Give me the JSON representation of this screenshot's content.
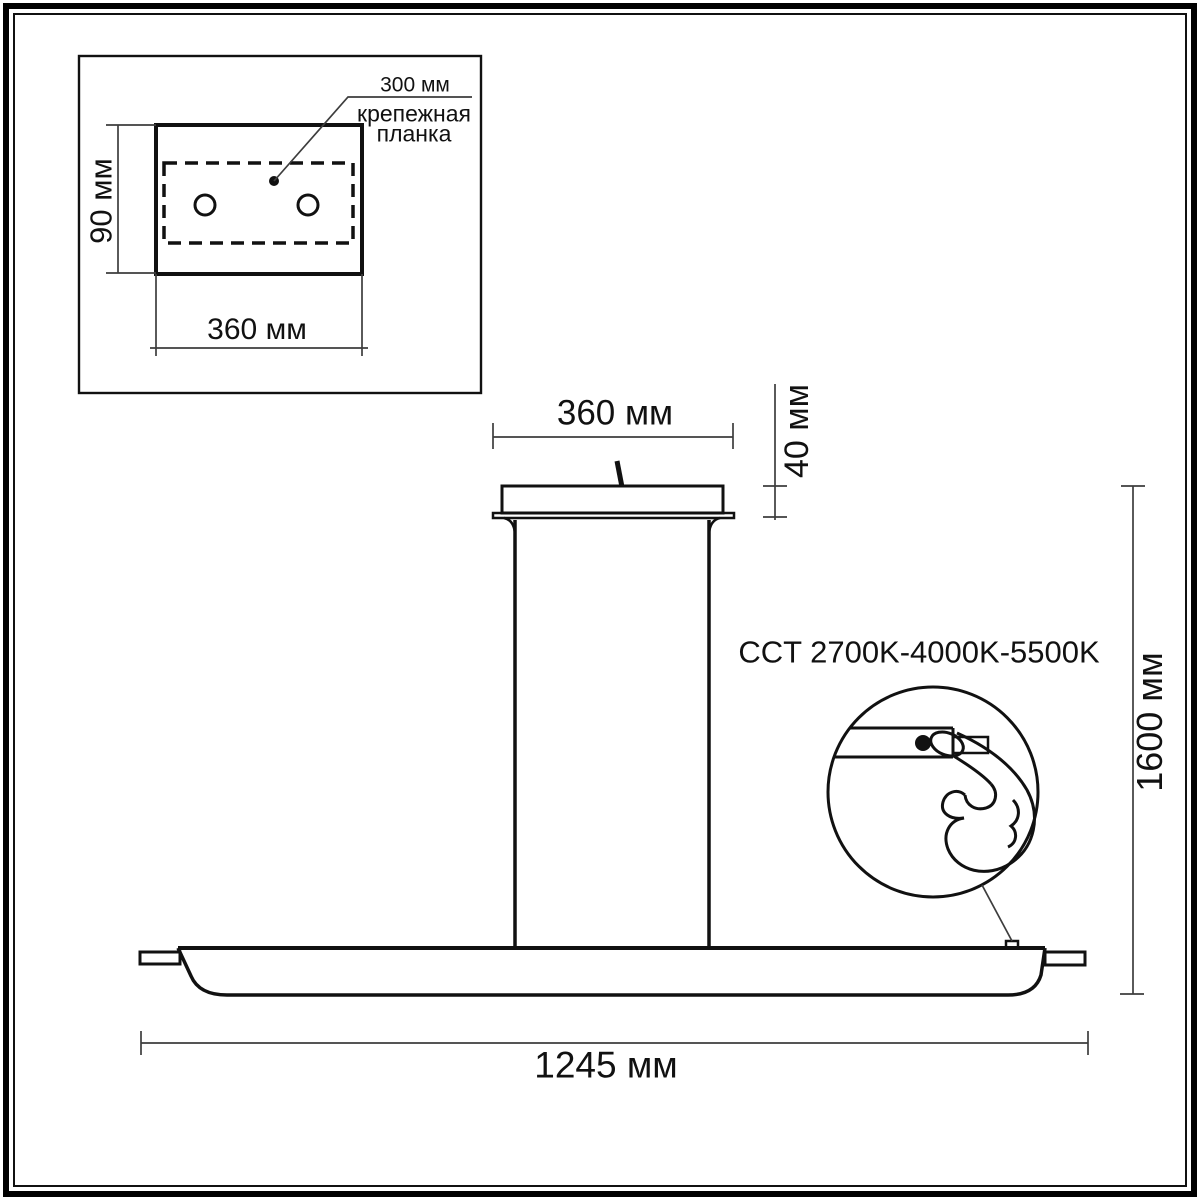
{
  "page": {
    "background_color": "#ffffff",
    "drawing_line_color": "#111111",
    "dimension_line_color": "#3d3d3d"
  },
  "inset": {
    "callout": {
      "value": "300 мм",
      "label_line1": "крепежная",
      "label_line2": "планка"
    },
    "dims": {
      "height": "90 мм",
      "width": "360 мм"
    }
  },
  "main": {
    "dims": {
      "canopy_width": "360 мм",
      "canopy_height": "40 мм",
      "overall_height": "1600 мм",
      "bar_length": "1245 мм"
    },
    "cct": {
      "label": "CCT 2700K-4000K-5500K"
    }
  }
}
